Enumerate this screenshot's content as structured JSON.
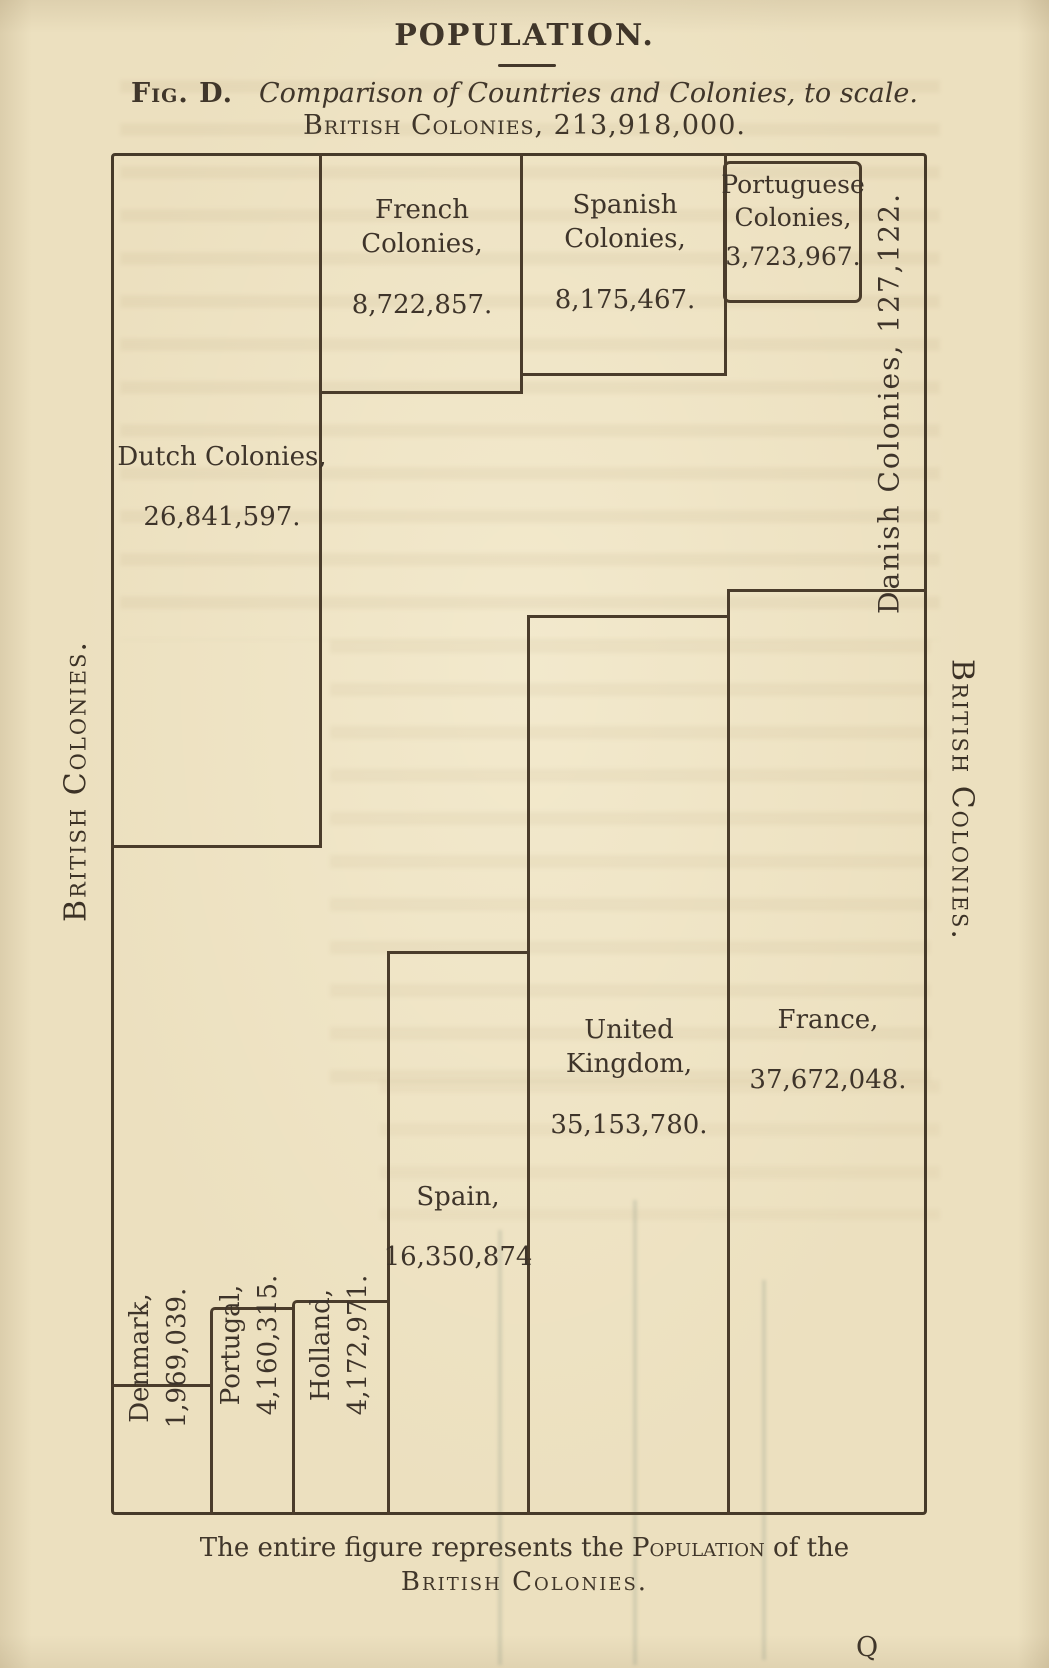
{
  "page": {
    "title": "POPULATION.",
    "figure_label": "Fig. D.",
    "figure_caption": "Comparison of Countries and Colonies, to scale.",
    "total_line": "British Colonies, 213,918,000.",
    "footer": {
      "pre": "The entire figure represents the ",
      "smallcaps": "Population",
      "post": " of the",
      "line2": "British Colonies."
    },
    "signature_mark": "Q"
  },
  "figure": {
    "side_labels": {
      "left": "British Colonies.",
      "right": "British Colonies."
    },
    "boxes": {
      "dutch": {
        "line1": "Dutch Colonies,",
        "value": "26,841,597."
      },
      "french": {
        "line1": "French",
        "line2": "Colonies,",
        "value": "8,722,857."
      },
      "spanish": {
        "line1": "Spanish",
        "line2": "Colonies,",
        "value": "8,175,467."
      },
      "portuguese": {
        "line1": "Portuguese",
        "line2": "Colonies,",
        "value": "3,723,967."
      },
      "danish": {
        "label": "Danish Colonies, 127,122."
      },
      "uk": {
        "line1": "United",
        "line2": "Kingdom,",
        "value": "35,153,780."
      },
      "france": {
        "line1": "France,",
        "value": "37,672,048."
      },
      "spain": {
        "line1": "Spain,",
        "value": "16,350,874"
      },
      "denmark": {
        "line1": "Denmark,",
        "value": "1,969,039."
      },
      "portugal": {
        "line1": "Portugal,",
        "value": "4,160,315."
      },
      "holland": {
        "line1": "Holland,",
        "value": "4,172,971."
      }
    }
  },
  "colors": {
    "paper": "#ece0bf",
    "ink": "#40362a",
    "line": "#4a3c2b"
  },
  "chart_data": {
    "type": "area",
    "title": "POPULATION.",
    "subtitle": "Fig. D. Comparison of Countries and Colonies, to scale.",
    "note": "The entire figure represents the Population of the British Colonies.",
    "unit": "persons",
    "total": {
      "name": "British Colonies",
      "population": 213918000
    },
    "entries": [
      {
        "name": "French Colonies",
        "population": 8722857
      },
      {
        "name": "Spanish Colonies",
        "population": 8175467
      },
      {
        "name": "Portuguese Colonies",
        "population": 3723967
      },
      {
        "name": "Danish Colonies",
        "population": 127122
      },
      {
        "name": "Dutch Colonies",
        "population": 26841597
      },
      {
        "name": "United Kingdom",
        "population": 35153780
      },
      {
        "name": "France",
        "population": 37672048
      },
      {
        "name": "Spain",
        "population": 16350874
      },
      {
        "name": "Denmark",
        "population": 1969039
      },
      {
        "name": "Portugal",
        "population": 4160315
      },
      {
        "name": "Holland",
        "population": 4172971
      }
    ]
  }
}
